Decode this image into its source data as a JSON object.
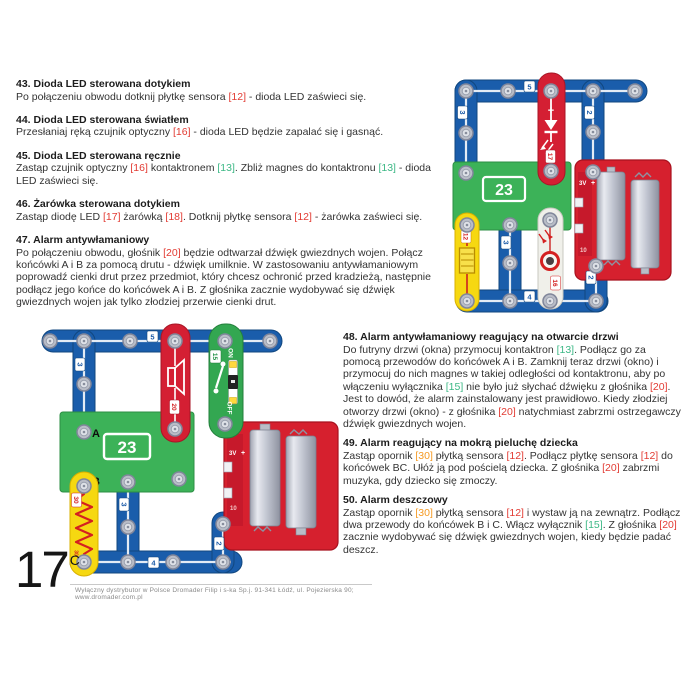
{
  "page": {
    "number": "17",
    "number_superscript": "C",
    "footer": "Wyłączny dystrybutor w Polsce Dromader Filip i s-ka Sp.j. 91-341 Łódź, ul. Pojezierska 90; www.dromader.com.pl"
  },
  "ref_colors": {
    "12": "#e23b33",
    "13": "#3db886",
    "15": "#3db886",
    "16": "#e23b33",
    "17": "#e23b33",
    "18": "#e23b33",
    "20": "#e23b33",
    "30": "#f59a23"
  },
  "sections_left": [
    {
      "num": "43.",
      "title": "Dioda LED sterowana dotykiem",
      "body": "Po połączeniu obwodu dotknij płytkę sensora [12] - dioda LED zaświeci się."
    },
    {
      "num": "44.",
      "title": "Dioda LED sterowana światłem",
      "body": "Przesłaniaj ręką czujnik optyczny [16] - dioda LED będzie zapalać się i gasnąć."
    },
    {
      "num": "45.",
      "title": "Dioda LED sterowana ręcznie",
      "body": "Zastąp czujnik optyczny [16] kontaktronem [13]. Zbliż magnes do kontaktronu [13] - dioda LED zaświeci się."
    },
    {
      "num": "46.",
      "title": "Żarówka sterowana dotykiem",
      "body": "Zastąp diodę LED [17] żarówką [18]. Dotknij płytkę sensora [12] - żarówka zaświeci się."
    },
    {
      "num": "47.",
      "title": "Alarm antywłamaniowy",
      "body": "Po połączeniu obwodu, głośnik [20] będzie odtwarzał dźwięk gwiezdnych wojen. Połącz końcówki A i B za pomocą drutu - dźwięk umilknie. W zastosowaniu antywłamaniowym poprowadź cienki drut przez przedmiot, który chcesz ochronić przed kradzieżą, następnie podłącz jego końce do końcówek A i B. Z głośnika zacznie wydobywać się dźwięk gwiezdnych wojen jak tylko złodziej przerwie cienki drut."
    }
  ],
  "sections_right": [
    {
      "num": "48.",
      "title": "Alarm antywłamaniowy reagujący na otwarcie drzwi",
      "body": "Do futryny drzwi (okna) przymocuj kontaktron [13]. Podłącz go za pomocą przewodów do końcówek A i B. Zamknij teraz drzwi (okno) i przymocuj do nich magnes w takiej odległości od kontaktronu, aby po włączeniu wyłącznika [15] nie było już słychać dźwięku z głośnika [20]. Jest to dowód, że alarm zainstalowany jest prawidłowo. Kiedy złodziej otworzy drzwi (okno) - z głośnika [20] natychmiast zabrzmi ostrzegawczy dźwięk gwiezdnych wojen."
    },
    {
      "num": "49.",
      "title": "Alarm reagujący na mokrą pieluchę dziecka",
      "body": "Zastąp opornik [30] płytką sensora [12]. Podłącz płytkę sensora [12] do końcówek BC. Ułóż ją pod pościelą dziecka. Z głośnika [20] zabrzmi muzyka, gdy dziecko się zmoczy."
    },
    {
      "num": "50.",
      "title": "Alarm deszczowy",
      "body": "Zastąp opornik [30] płytką sensora [12] i wystaw ją na zewnątrz. Podłącz dwa przewody do końcówek B i C. Włącz wyłącznik [15]. Z głośnika [20] zacznie wydobywać się dźwięk gwiezdnych wojen, kiedy będzie padać deszcz."
    }
  ],
  "circuit_top": {
    "labels": {
      "w5": "5",
      "w3": "3",
      "w2": "2",
      "w3b": "3",
      "w4": "4",
      "w2b": "2",
      "plus": "+",
      "led": "17",
      "ic": "23",
      "plate": "12",
      "optical": "16",
      "batt_v": "3V",
      "batt_plus": "+",
      "batt_num": "10"
    }
  },
  "circuit_bottom": {
    "labels": {
      "w5": "5",
      "w3": "3",
      "w3b": "3",
      "w4": "4",
      "w2": "2",
      "speaker": "20",
      "sw": "15",
      "on": "ON",
      "off": "OFF",
      "ic": "23",
      "term_a": "A",
      "term_b": "B",
      "res": "30",
      "res2": "30",
      "batt_v": "3V",
      "batt_plus": "+",
      "batt_num": "10"
    }
  }
}
